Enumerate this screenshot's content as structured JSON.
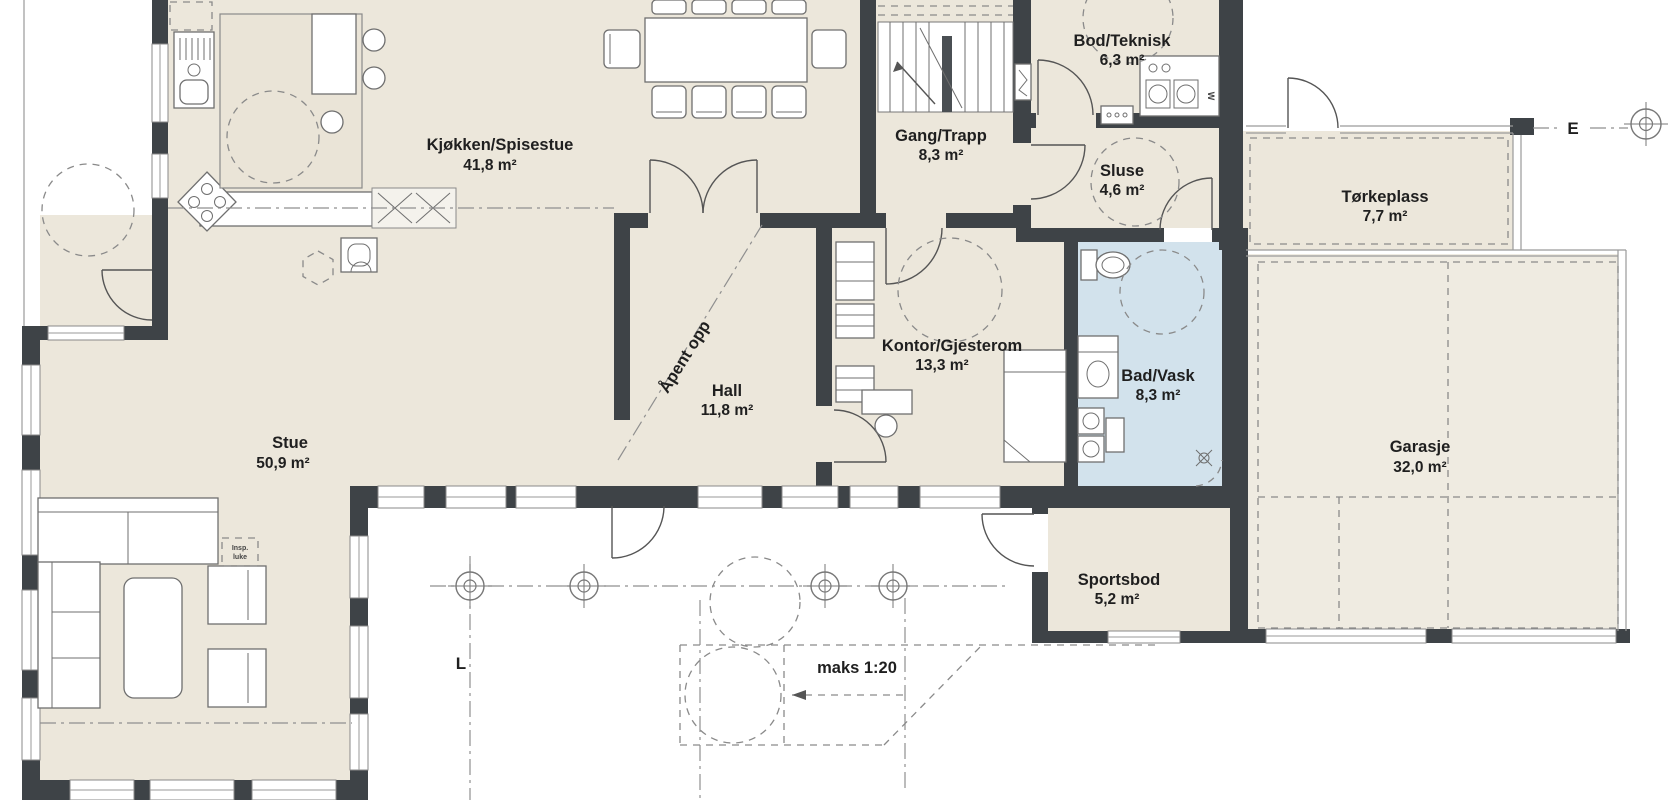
{
  "palette": {
    "floor": "#ECE7DB",
    "garage_floor": "#EFEBE1",
    "bath_floor": "#D2E2EC",
    "wall": "#3E4347",
    "furniture_line": "#6f6f6f",
    "dash_line": "#8a8a8a",
    "text": "#1f1f1f"
  },
  "drawing": {
    "type": "floor-plan",
    "language": "Norwegian"
  },
  "rooms": [
    {
      "id": "kjokken",
      "name": "Kjøkken/Spisestue",
      "area": "41,8 m²"
    },
    {
      "id": "gang",
      "name": "Gang/Trapp",
      "area": "8,3 m²"
    },
    {
      "id": "bod",
      "name": "Bod/Teknisk",
      "area": "6,3 m²"
    },
    {
      "id": "sluse",
      "name": "Sluse",
      "area": "4,6 m²"
    },
    {
      "id": "torkeplass",
      "name": "Tørkeplass",
      "area": "7,7 m²"
    },
    {
      "id": "hall",
      "name": "Hall",
      "area": "11,8 m²"
    },
    {
      "id": "kontor",
      "name": "Kontor/Gjesterom",
      "area": "13,3 m²"
    },
    {
      "id": "bad",
      "name": "Bad/Vask",
      "area": "8,3 m²"
    },
    {
      "id": "stue",
      "name": "Stue",
      "area": "50,9 m²"
    },
    {
      "id": "garasje",
      "name": "Garasje",
      "area": "32,0 m²"
    },
    {
      "id": "sportsbod",
      "name": "Sportsbod",
      "area": "5,2 m²"
    }
  ],
  "annotations": {
    "apent_opp": "Åpent opp",
    "maks": "maks 1:20",
    "insp_line1": "Insp.",
    "insp_line2": "luke",
    "axis_bottom": "L",
    "axis_right": "E",
    "washer": "W"
  }
}
